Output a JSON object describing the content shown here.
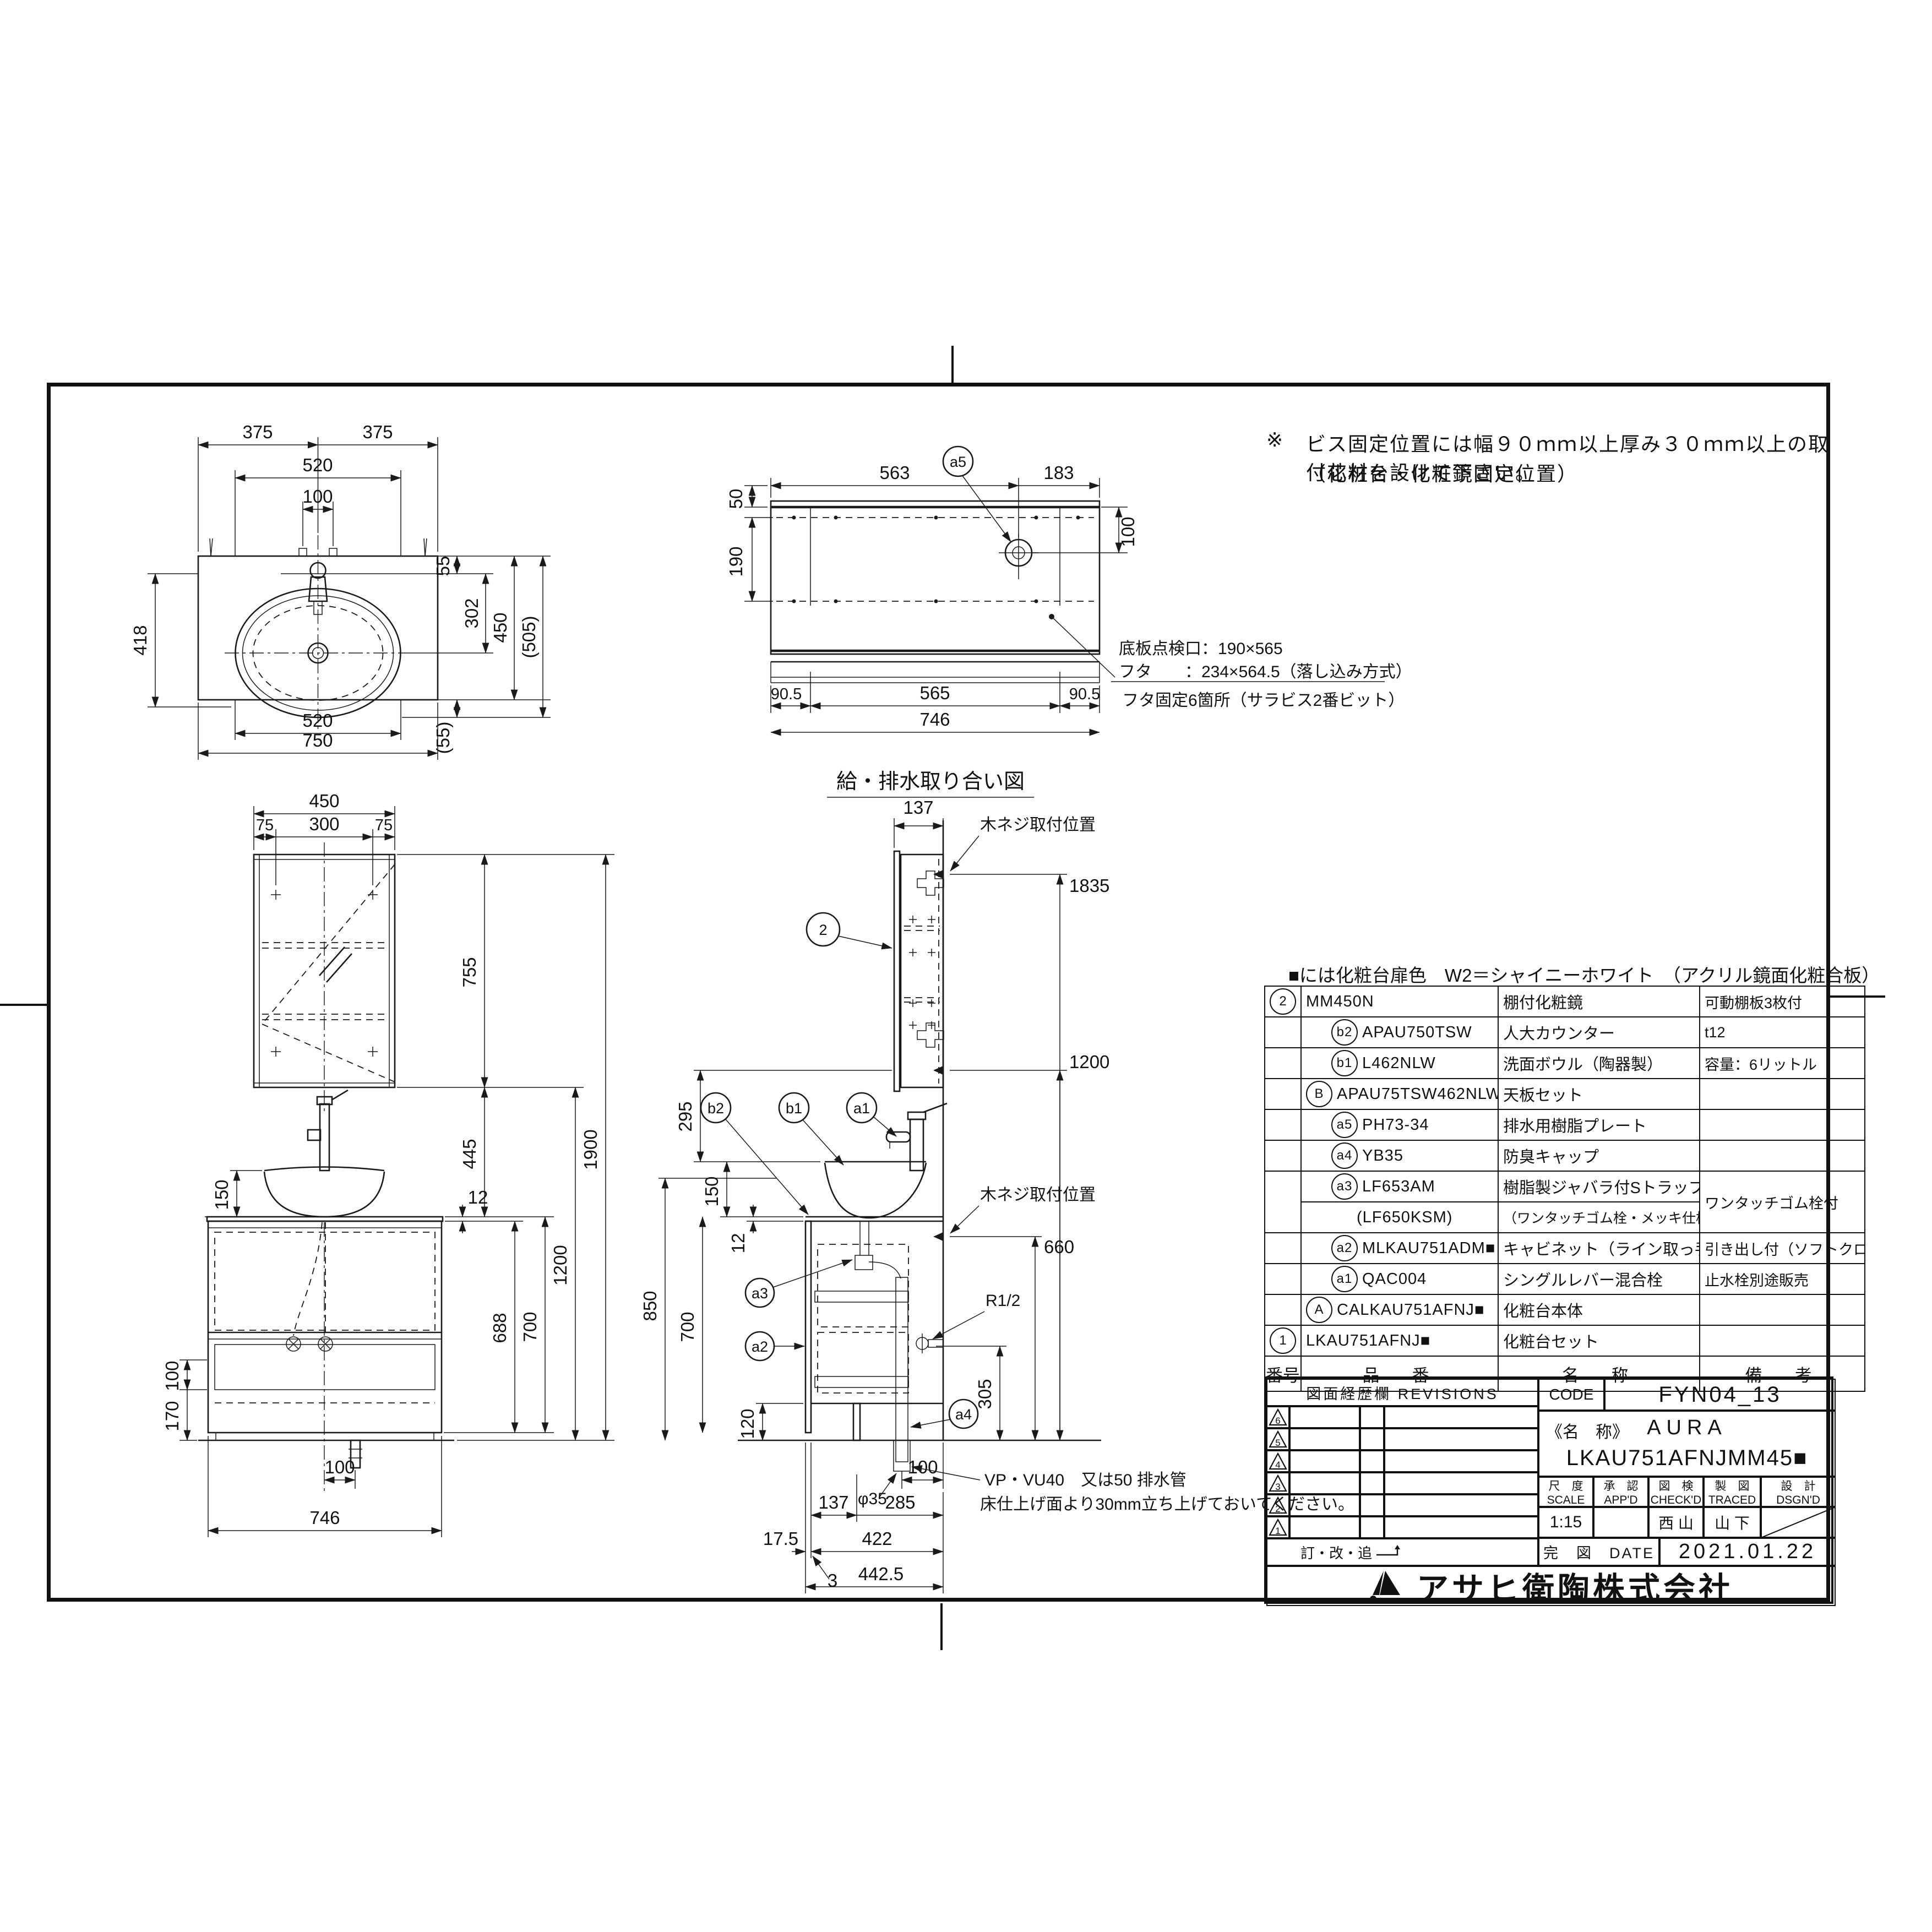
{
  "note": {
    "mark": "※",
    "line1": "ビス固定位置には幅９０ｍｍ以上厚み３０ｍｍ以上の取付芯材を設けて下さい。",
    "line2": "（化粧台・化粧鏡固定位置）"
  },
  "plan_view": {
    "dims": {
      "top_left": "375",
      "top_right": "375",
      "cutout_top": "520",
      "holes": "100",
      "left_418": "418",
      "r55": "55",
      "r302": "302",
      "r450": "450",
      "r505": "(505)",
      "r55b": "(55)",
      "bottom_520": "520",
      "bottom_750": "750"
    }
  },
  "plumbing_view": {
    "caption": "給・排水取り合い図",
    "balloon_a5": "a5",
    "dims": {
      "d50": "50",
      "d563": "563",
      "d183": "183",
      "d190": "190",
      "d100": "100",
      "d905l": "90.5",
      "d565": "565",
      "d905r": "90.5",
      "d746": "746"
    },
    "note1": "底板点検口：190×565",
    "note2": "フタ　　：234×564.5（落し込み方式）",
    "note3": "フタ固定6箇所（サラビス2番ビット）"
  },
  "front_view": {
    "dims": {
      "d450": "450",
      "d75l": "75",
      "d300": "300",
      "d75r": "75",
      "d755": "755",
      "d1200": "1200",
      "d1900": "1900",
      "d445": "445",
      "d12": "12",
      "d688": "688",
      "d700": "700",
      "d150": "150",
      "d100l": "100",
      "d170": "170",
      "d100b": "100",
      "d746": "746"
    }
  },
  "side_view": {
    "dims": {
      "d137": "137",
      "d1835": "1835",
      "d1200": "1200",
      "d295": "295",
      "d150": "150",
      "d12": "12",
      "d850": "850",
      "d700": "700",
      "d120": "120",
      "d660": "660",
      "d305": "305",
      "r12": "R1/2",
      "phi35": "φ35",
      "d100": "100",
      "d137b": "137",
      "d285": "285",
      "d175": "17.5",
      "d422": "422",
      "d3": "3",
      "d4425": "442.5"
    },
    "labels": {
      "screw_top": "木ネジ取付位置",
      "screw_mid": "木ネジ取付位置",
      "drain1": "VP・VU40　又は50 排水管",
      "drain2": "床仕上げ面より30mm立ち上げておいてください。"
    },
    "balloons": {
      "b2": "b2",
      "b1": "b1",
      "a1": "a1",
      "a2": "a2",
      "a3": "a3",
      "a4": "a4",
      "n2": "2"
    }
  },
  "parts": {
    "color_note": "■には化粧台扉色　W2＝シャイニーホワイト　（アクリル鏡面化粧合板）",
    "header": {
      "no": "番号",
      "pn": "品　番",
      "name": "名　称",
      "remarks": "備　考"
    },
    "rows": [
      {
        "no": "2",
        "level": 0,
        "pn": "MM450N",
        "name": "棚付化粧鏡",
        "remarks": "可動棚板3枚付"
      },
      {
        "no": "b2",
        "level": 2,
        "pn": "APAU750TSW",
        "name": "人大カウンター",
        "remarks": "t12"
      },
      {
        "no": "b1",
        "level": 2,
        "pn": "L462NLW",
        "name": "洗面ボウル（陶器製）",
        "remarks": "容量：6リットル"
      },
      {
        "no": "B",
        "level": 1,
        "pn": "APAU75TSW462NLWA",
        "name": "天板セット",
        "remarks": ""
      },
      {
        "no": "a5",
        "level": 2,
        "pn": "PH73-34",
        "name": "排水用樹脂プレート",
        "remarks": ""
      },
      {
        "no": "a4",
        "level": 2,
        "pn": "YB35",
        "name": "防臭キャップ",
        "remarks": ""
      },
      {
        "no": "a3",
        "level": 2,
        "pn": "LF653AM",
        "name": "樹脂製ジャバラ付Sトラップ",
        "remarks": "ワンタッチゴム栓付",
        "double": true,
        "pn2": "(LF650KSM)",
        "name2": "（ワンタッチゴム栓・メッキ仕様）"
      },
      {
        "no": "a2",
        "level": 2,
        "pn": "MLKAU751ADM■",
        "name": "キャビネット（ライン取っ手）",
        "remarks": "引き出し付（ソフトクローズ）"
      },
      {
        "no": "a1",
        "level": 2,
        "pn": "QAC004",
        "name": "シングルレバー混合栓",
        "remarks": "止水栓別途販売"
      },
      {
        "no": "A",
        "level": 1,
        "pn": "CALKAU751AFNJ■",
        "name": "化粧台本体",
        "remarks": ""
      },
      {
        "no": "1",
        "level": 0,
        "pn": "LKAU751AFNJ■",
        "name": "化粧台セット",
        "remarks": ""
      }
    ]
  },
  "title_block": {
    "revisions_label": "図面経歴欄 REVISIONS",
    "revision_numbers": [
      "6",
      "5",
      "4",
      "3",
      "2",
      "1"
    ],
    "correction_label": "訂・改・追",
    "code_label": "CODE",
    "code": "FYN04_13",
    "name_label": "《名　称》",
    "name1": "AURA",
    "name2": "LKAU751AFNJMM45■",
    "scale_jp": "尺　度",
    "scale_en": "SCALE",
    "scale": "1:15",
    "appd_jp": "承　認",
    "appd_en": "APP'D",
    "appd": "",
    "checkd_jp": "図　検",
    "checkd_en": "CHECK'D",
    "checkd": "西 山",
    "traced_jp": "製　図",
    "traced_en": "TRACED",
    "traced": "山 下",
    "dsgnd_jp": "設　計",
    "dsgnd_en": "DSGN'D",
    "date_label": "完　図　DATE",
    "date": "2021.01.22",
    "company": "アサヒ衛陶株式会社"
  }
}
